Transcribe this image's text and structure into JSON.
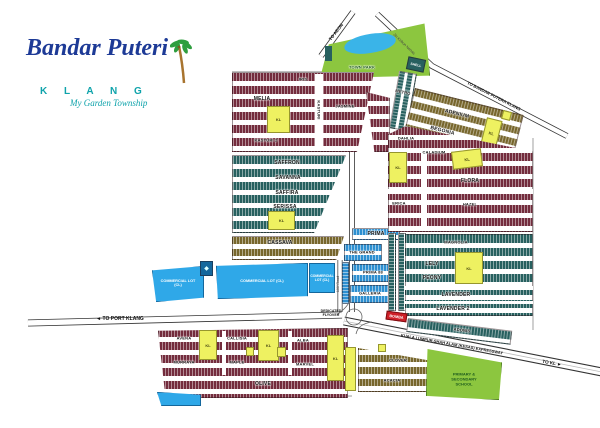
{
  "logo": {
    "title": "Bandar Puteri",
    "subtitle": "K L A N G",
    "tagline": "My Garden Township"
  },
  "roads": {
    "to_aeon": "TO AEON",
    "kebun_nenas": "Jln Kebun Nenas",
    "to_bandar_putera": "TO BANDAR PUTERA KLANG",
    "to_port_klang": "◄ TO PORT KLANG",
    "kesas": "KUALA LUMPUR-SHAH ALAM (KESAS) EXPRESSWAY",
    "to_kl": "TO KL ►",
    "flyover": "DEDICATED FLYOVER",
    "road_100": "100' Road"
  },
  "landmarks": {
    "town_park": "TOWN PARK",
    "shell": "SHELL",
    "bomba": "BOMBA",
    "school": "PRIMARY & SECONDARY SCHOOL",
    "commercial_lot": "COMMERCIAL LOT (CL)",
    "kl": "KL"
  },
  "precincts": {
    "iris": "IRIS",
    "melia": "MELIA",
    "kasturi": "KASTURI",
    "kasturi2": "KASTURI 2",
    "jasmine": "JASMINE",
    "saffron": "SAFFRON",
    "savanna": "SAVANNA",
    "saffira": "SAFFIRA",
    "serissa": "SERISSA",
    "cassava": "CASSAVA",
    "metro": "METRO",
    "adenium": "ADENIUM",
    "begonia": "BEGONIA",
    "dahlia": "DAHLIA",
    "caladium": "CALADIUM",
    "flora": "FLORA",
    "erica": "ERICA",
    "hazel": "HAZEL",
    "prima": "PRIMA",
    "the_grand": "THE GRAND",
    "prima88": "PRIMA 88",
    "galleria": "GALLERIA",
    "magnolia": "MAGNOLIA",
    "lely": "LELY",
    "peony": "PEONY",
    "lavender": "LAVENDER",
    "lavender2": "LAVENDER 2",
    "adonis": "ADONIS",
    "avena": "AVENA",
    "callisia": "CALLISIA",
    "alba": "ALBA",
    "murraya": "MURRAYA",
    "maple": "MAPLE",
    "marvel": "MARVEL",
    "olive": "OLIVE",
    "clover": "CLOVER",
    "acacia": "ACACIA"
  },
  "colors": {
    "rowhouse_red": "#732c3d",
    "rowhouse_teal": "#27605f",
    "rowhouse_brown": "#77662c",
    "commercial_blue": "#2fa8e8",
    "lot_yellow": "#eef161",
    "park_green": "#8cc63f",
    "logo_blue": "#1d3a96",
    "logo_teal": "#0fa3ab",
    "bomba_red": "#cf2028"
  }
}
